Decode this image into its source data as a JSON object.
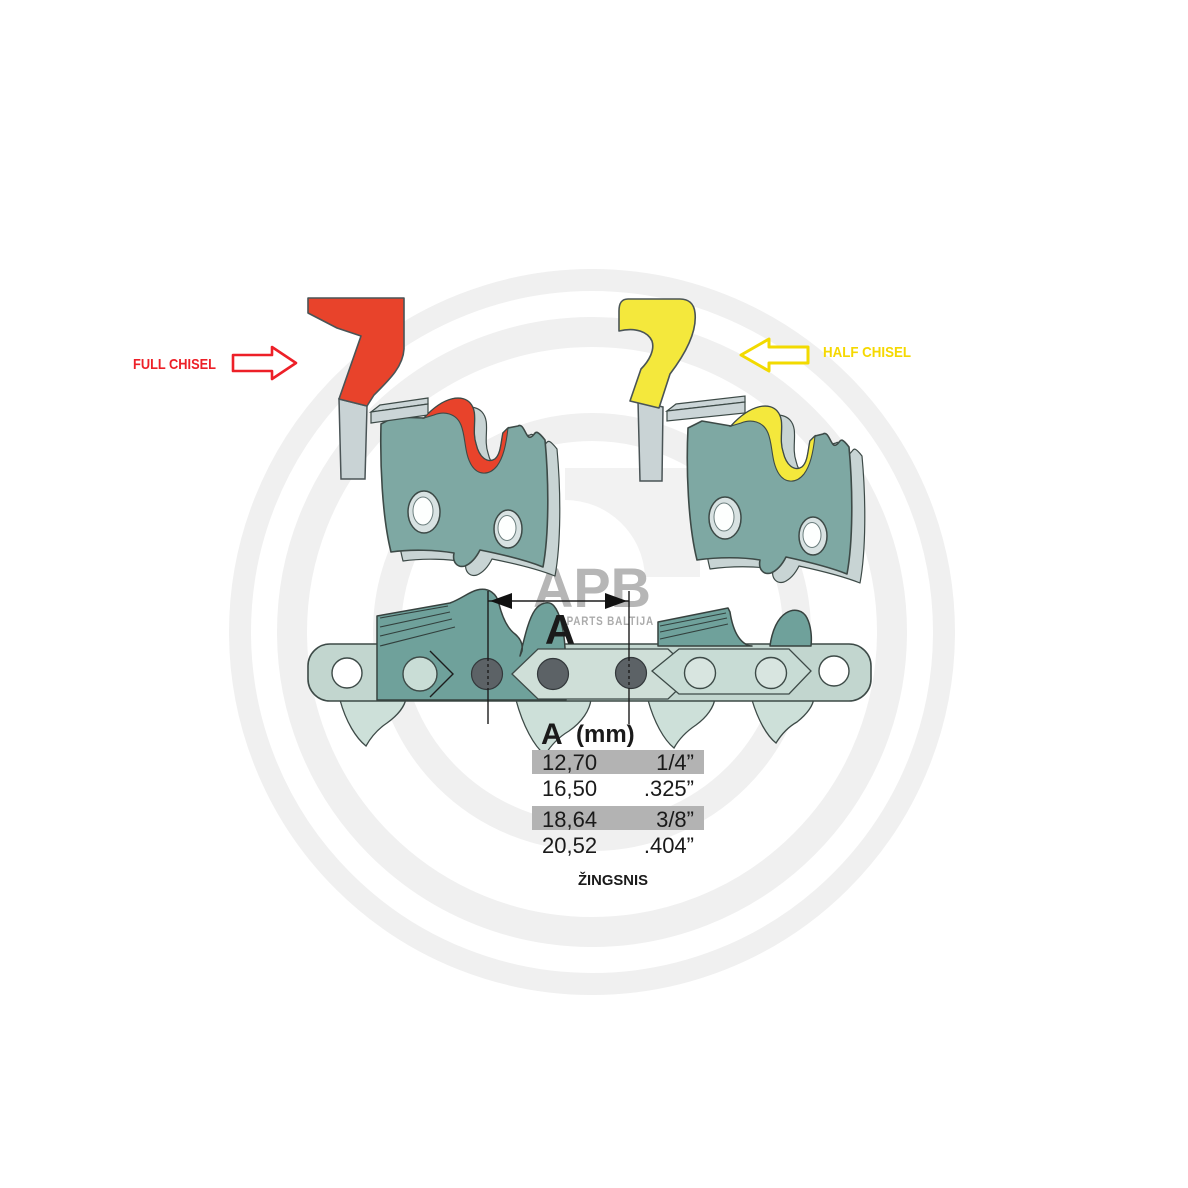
{
  "watermark": {
    "brand": "APB",
    "subtitle": "AGRO PARTS BALTIJA"
  },
  "annotations": {
    "full_chisel": {
      "label": "FULL CHISEL",
      "color": "#ed2028"
    },
    "half_chisel": {
      "label": "HALF CHISEL",
      "color": "#ffe100"
    }
  },
  "dimension": {
    "letter": "A"
  },
  "pitch_table": {
    "header_letter": "A",
    "header_unit": "(mm)",
    "rows": [
      {
        "mm": "12,70",
        "inch": "1/4”",
        "highlighted": true
      },
      {
        "mm": "16,50",
        "inch": ".325”",
        "highlighted": false
      },
      {
        "mm": "18,64",
        "inch": "3/8”",
        "highlighted": true
      },
      {
        "mm": "20,52",
        "inch": ".404”",
        "highlighted": false
      }
    ],
    "caption": "ŽINGSNIS",
    "highlight_color": "#b3b3b3"
  },
  "colors": {
    "full_chisel_red": "#e8432b",
    "half_chisel_yellow": "#f4e83c",
    "plate_teal": "#7ea8a3",
    "cutter_teal": "#6fa19b",
    "chain_light": "#c2d6cf",
    "rivet_gray": "#5c6266",
    "outline": "#3d4a47",
    "watermark_gray": "#b6b6b6"
  }
}
